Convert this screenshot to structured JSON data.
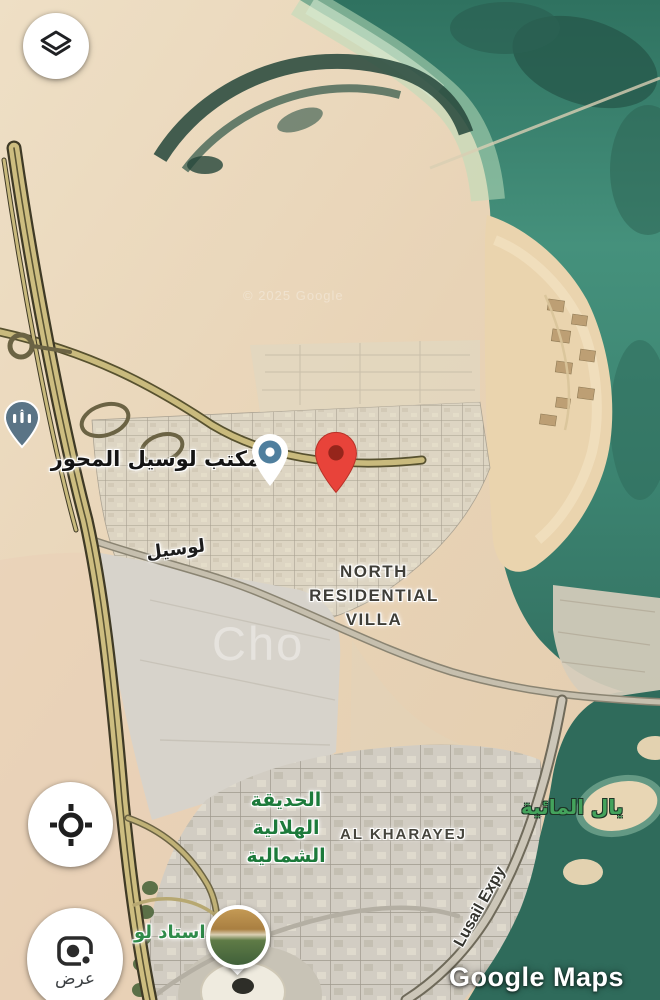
{
  "app": {
    "attribution": "Google Maps"
  },
  "controls": {
    "layers_button": {
      "icon": "layers"
    },
    "my_location_button": {
      "icon": "crosshair"
    },
    "view_button": {
      "icon": "camera",
      "label": "عرض"
    }
  },
  "map": {
    "labels": {
      "office": "مكتب لوسيل المحور",
      "road_lusail": "لوسيل",
      "north_villa_lines": [
        "NORTH",
        "RESIDENTIAL",
        "VILLA"
      ],
      "park_lines": [
        "الحديقة",
        "الهلالية",
        "الشمالية"
      ],
      "al_kharayej": "AL KHARAYEJ",
      "water_right": "يال المائية",
      "stadium": "استاد لو",
      "road_expy": "Lusail Expy"
    },
    "watermarks": {
      "copyright": "© 2025 Google",
      "brand": "Cho"
    },
    "markers": {
      "destination_pin": "red destination pin",
      "poi_pin": "point-of-interest pin",
      "mosque_pin": "mosque marker"
    },
    "colors": {
      "sand": "#e9d5ba",
      "water": "#3f8973",
      "water_dark": "#2b5f50",
      "shallow": "#b4dabb",
      "highway": "#cbbc7f",
      "urban": "#d8d2c4",
      "pin_red": "#e8433a",
      "poi_blue": "#4f7f9e",
      "label_green": "#1c7a3b"
    }
  }
}
